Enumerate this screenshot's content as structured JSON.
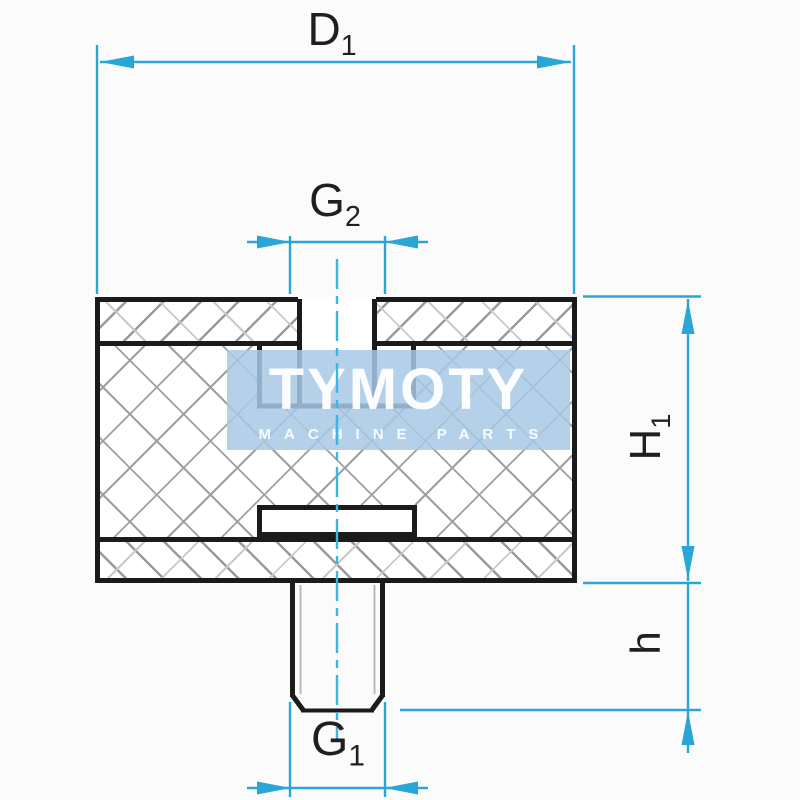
{
  "drawing": {
    "type": "technical-cross-section",
    "part": "rubber-metal buffer with threaded hole and stud"
  },
  "labels": {
    "d1": {
      "base": "D",
      "sub": "1"
    },
    "g2": {
      "base": "G",
      "sub": "2"
    },
    "h1": {
      "base": "H",
      "sub": "1"
    },
    "h": {
      "base": "h",
      "sub": ""
    },
    "g1": {
      "base": "G",
      "sub": "1"
    }
  },
  "watermark": {
    "line1": "TYMOTY",
    "line2": "MACHINE PARTS"
  },
  "colors": {
    "dimension": "#2aa5d8",
    "centerline": "#3cb4e6",
    "outline": "#1b1b1b",
    "hatch": "#9a9a9a",
    "watermark_band": "#a8c9e6",
    "watermark_text": "#ffffff",
    "background": "#fbfbfb"
  }
}
